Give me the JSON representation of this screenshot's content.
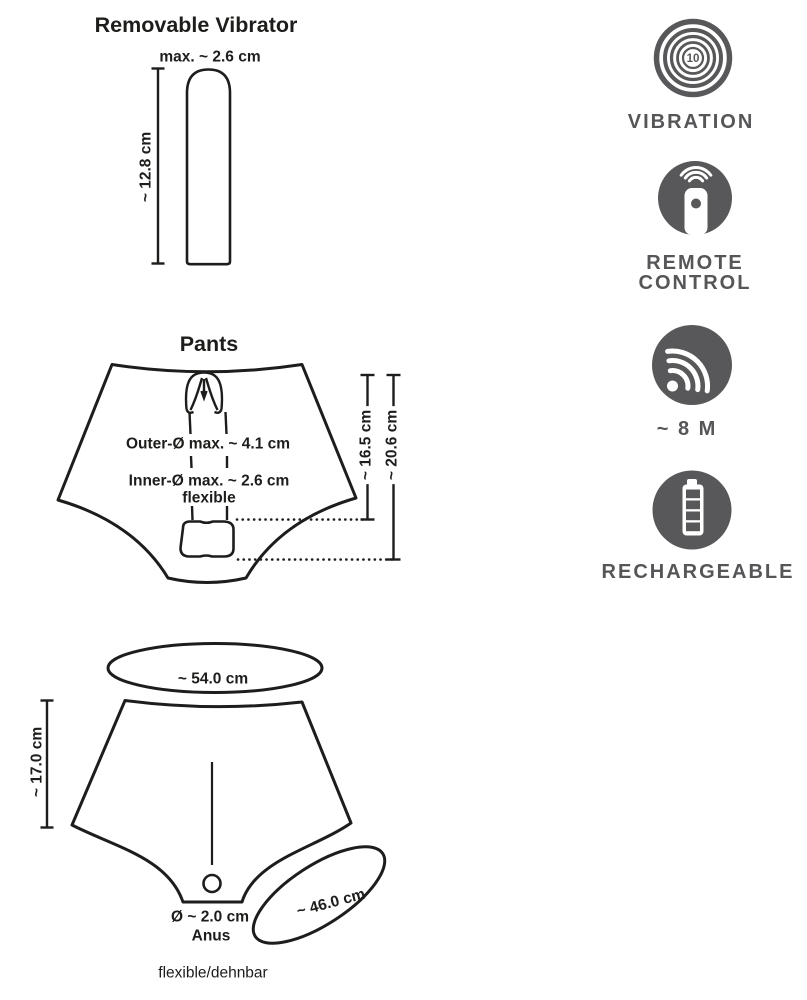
{
  "colors": {
    "line": "#1d1d1b",
    "icon_gray": "#58585a",
    "icon_label_gray": "#565659",
    "background": "#ffffff"
  },
  "vibrator_section": {
    "title": "Removable Vibrator",
    "width_label": "max. ~ 2.6 cm",
    "length_label": "~ 12.8 cm"
  },
  "pants_section": {
    "title": "Pants",
    "outer_diameter_label": "Outer-Ø max. ~ 4.1 cm",
    "inner_diameter_label": "Inner-Ø max. ~ 2.6 cm",
    "flexible_label": "flexible",
    "inner_length_label": "~ 16.5 cm",
    "outer_length_label": "~ 20.6 cm"
  },
  "size_section": {
    "waist_circumference_label": "~ 54.0 cm",
    "height_label": "~ 17.0 cm",
    "anus_diameter_label": "Ø ~ 2.0 cm",
    "anus_label": "Anus",
    "leg_circumference_label": "~ 46.0 cm",
    "stretch_label": "flexible/dehnbar"
  },
  "features": [
    {
      "name": "vibration",
      "label": "VIBRATION",
      "value": "10"
    },
    {
      "name": "remote-control",
      "label": "REMOTE CONTROL"
    },
    {
      "name": "range",
      "label": "~ 8 M"
    },
    {
      "name": "rechargeable",
      "label": "RECHARGEABLE"
    }
  ]
}
